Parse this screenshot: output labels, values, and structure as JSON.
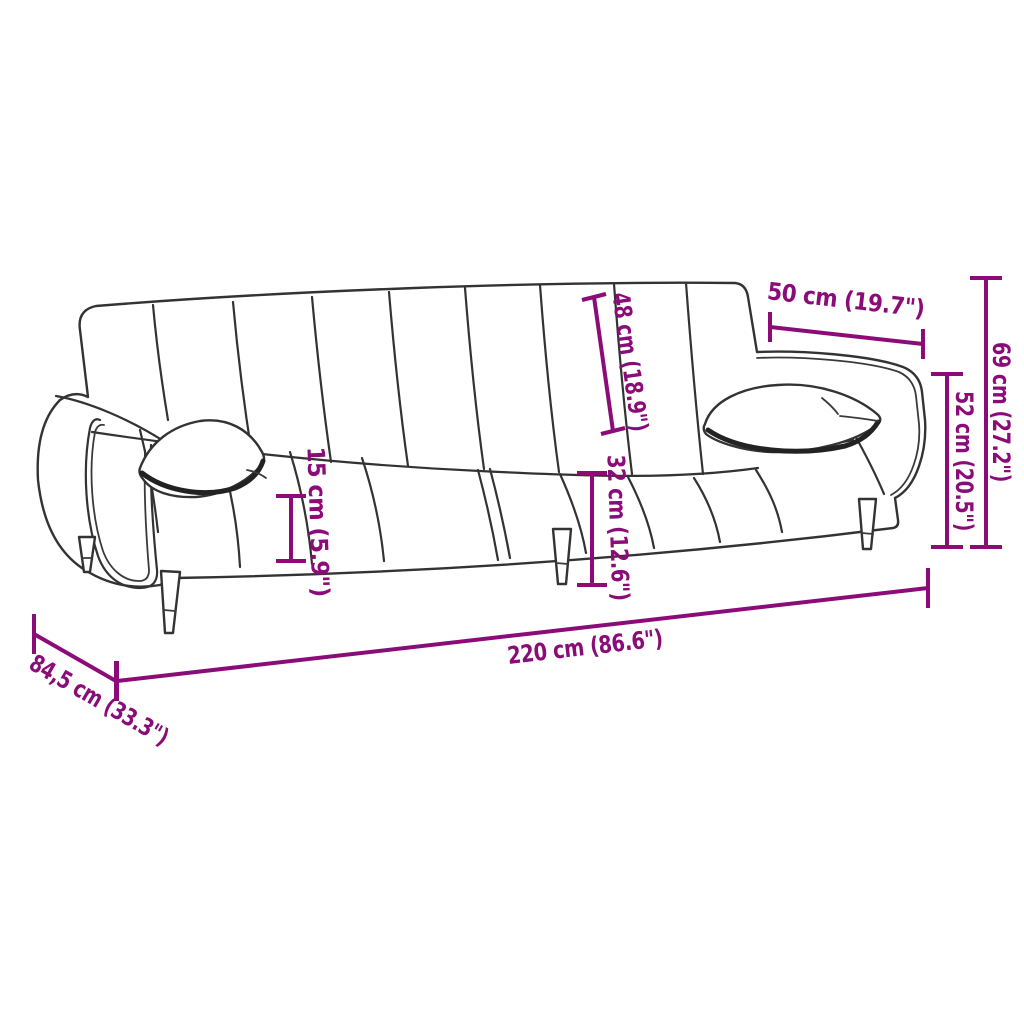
{
  "diagram": {
    "kind": "product-dimension-diagram",
    "subject": "sofa-bed-with-armrest-pillows",
    "background_color": "#ffffff",
    "outline_color": "#333333",
    "dimension_color": "#8B0C78",
    "dimensions": {
      "backrest_height": "48 cm (18.9\")",
      "armrest_section_width": "50 cm (19.7\")",
      "overall_height": "69 cm (27.2\")",
      "armrest_height": "52 cm (20.5\")",
      "seat_cushion_thickness": "15 cm (5.9\")",
      "seat_height": "32 cm (12.6\")",
      "overall_width": "220 cm (86.6\")",
      "overall_depth": "84,5 cm (33.3\")"
    }
  }
}
